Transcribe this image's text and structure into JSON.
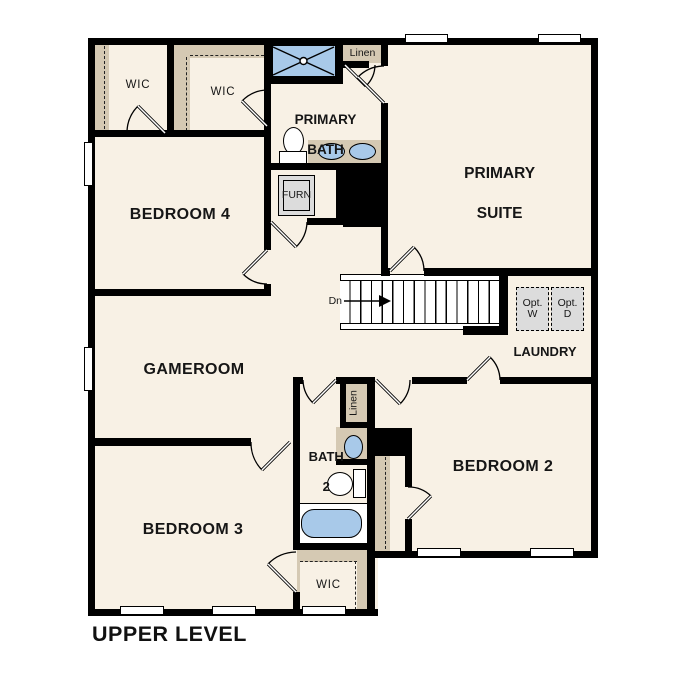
{
  "title": {
    "label": "UPPER LEVEL"
  },
  "colors": {
    "floor": "#f8f1e5",
    "wall": "#000000",
    "closet": "#d5c9b3",
    "fixture": "#a8c9e9",
    "appliance": "#dcdcdc"
  },
  "rooms": {
    "primary_suite": {
      "line1": "PRIMARY",
      "line2": "SUITE"
    },
    "primary_bath": {
      "line1": "PRIMARY",
      "line2": "BATH"
    },
    "bedroom4": {
      "label": "BEDROOM 4"
    },
    "bedroom3": {
      "label": "BEDROOM 3"
    },
    "bedroom2": {
      "label": "BEDROOM 2"
    },
    "gameroom": {
      "label": "GAMEROOM"
    },
    "laundry": {
      "label": "LAUNDRY"
    },
    "bath2": {
      "line1": "BATH",
      "line2": "2"
    },
    "wic_a": {
      "label": "WIC"
    },
    "wic_b": {
      "label": "WIC"
    },
    "wic_c": {
      "label": "WIC"
    },
    "linen_a": {
      "label": "Linen"
    },
    "linen_b": {
      "label": "Linen"
    },
    "furnace": {
      "label": "FURN"
    },
    "stairs": {
      "direction_label": "Dn"
    },
    "optional_washer": {
      "line1": "Opt.",
      "line2": "W"
    },
    "optional_dryer": {
      "line1": "Opt.",
      "line2": "D"
    }
  }
}
